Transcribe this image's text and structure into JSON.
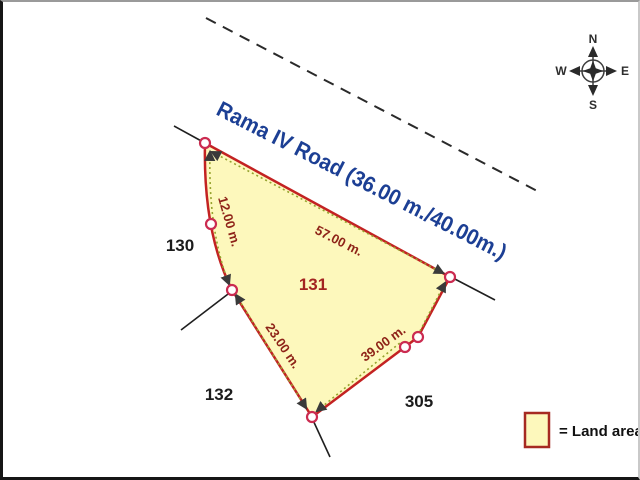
{
  "road": {
    "name_label": "Rama IV Road (36.00 m./40.00m.)"
  },
  "compass": {
    "north": "N",
    "east": "E",
    "south": "S",
    "west": "W"
  },
  "parcel": {
    "id": "131",
    "edge_lengths": {
      "northwest_curve": "12.00 m.",
      "road_frontage": "57.00 m.",
      "southwest": "23.00 m.",
      "southeast": "39.00 m."
    }
  },
  "neighbors": {
    "west": "130",
    "south": "132",
    "southeast": "305"
  },
  "legend": {
    "land_area": "= Land area"
  },
  "colors": {
    "parcel_fill": "#fdf8bc",
    "parcel_border": "#c32222",
    "dimension_text": "#8e2318",
    "parcel_id_text": "#a32421",
    "road_text": "#1c3f94",
    "neighbor_text": "#1c1c1c",
    "survey_marker_stroke": "#cb2b50",
    "dotted_tie_line": "#96a22e"
  }
}
